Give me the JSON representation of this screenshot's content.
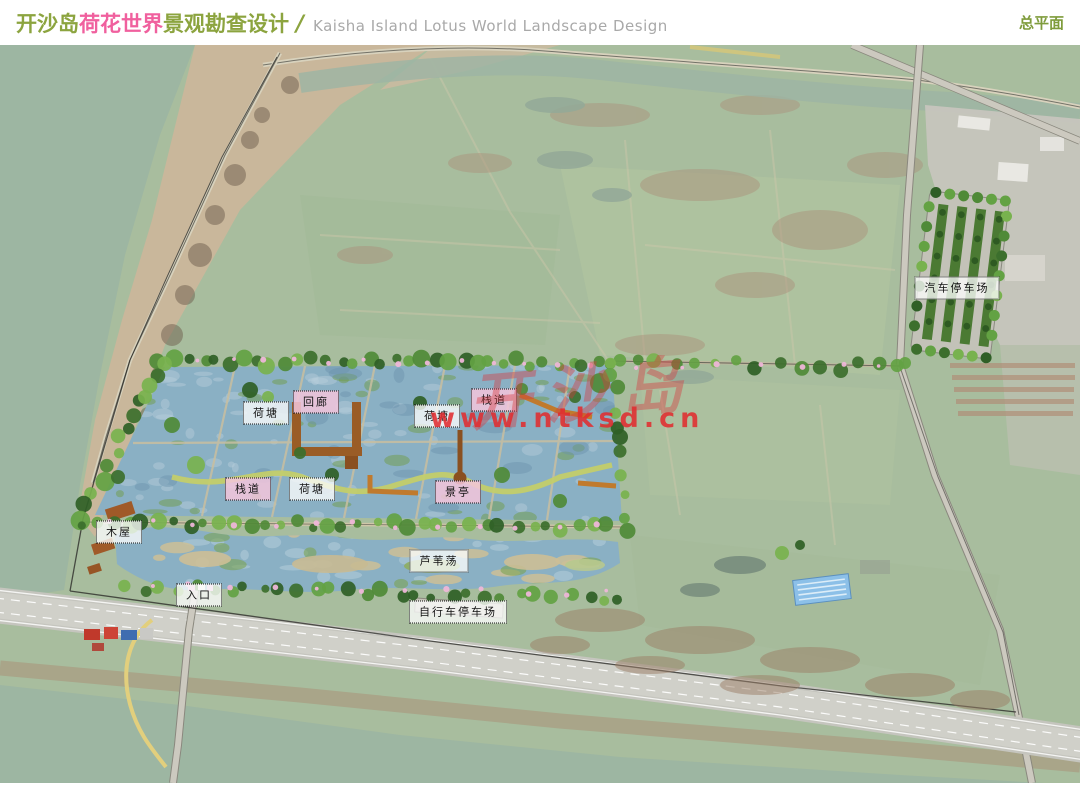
{
  "header": {
    "title_cn_1": "开沙岛",
    "title_cn_2": "荷花世界",
    "title_cn_3": "景观勘查设计",
    "separator": "/",
    "title_en": "Kaisha Island Lotus World Landscape Design",
    "page_label": "总平面",
    "accent_green": "#8ca43f",
    "accent_pink": "#f0609e",
    "plan_label_green": "#7f9c3c"
  },
  "map": {
    "watermark": {
      "calligraphy": "开沙岛",
      "url_text": "www.ntksd.cn",
      "color": "rgba(224,44,48,.88)"
    },
    "labels": [
      {
        "id": "lotus-pond-1",
        "text": "荷塘",
        "x": 266,
        "y": 368,
        "style": "white"
      },
      {
        "id": "corridor",
        "text": "回廊",
        "x": 316,
        "y": 357,
        "style": "pink"
      },
      {
        "id": "lotus-pond-2",
        "text": "荷塘",
        "x": 437,
        "y": 371,
        "style": "white"
      },
      {
        "id": "boardwalk-1",
        "text": "栈道",
        "x": 494,
        "y": 355,
        "style": "pink"
      },
      {
        "id": "boardwalk-2",
        "text": "栈道",
        "x": 248,
        "y": 444,
        "style": "pink"
      },
      {
        "id": "lotus-pond-3",
        "text": "荷塘",
        "x": 312,
        "y": 444,
        "style": "white"
      },
      {
        "id": "pavilion",
        "text": "景亭",
        "x": 458,
        "y": 447,
        "style": "pink"
      },
      {
        "id": "wood-cabin",
        "text": "木屋",
        "x": 119,
        "y": 487,
        "style": "white"
      },
      {
        "id": "entrance",
        "text": "入口",
        "x": 199,
        "y": 550,
        "style": "white"
      },
      {
        "id": "reed-marsh",
        "text": "芦苇荡",
        "x": 439,
        "y": 516,
        "style": "white"
      },
      {
        "id": "bicycle-parking",
        "text": "自行车停车场",
        "x": 458,
        "y": 567,
        "style": "white"
      },
      {
        "id": "car-parking",
        "text": "汽车停车场",
        "x": 957,
        "y": 243,
        "style": "white"
      }
    ]
  }
}
